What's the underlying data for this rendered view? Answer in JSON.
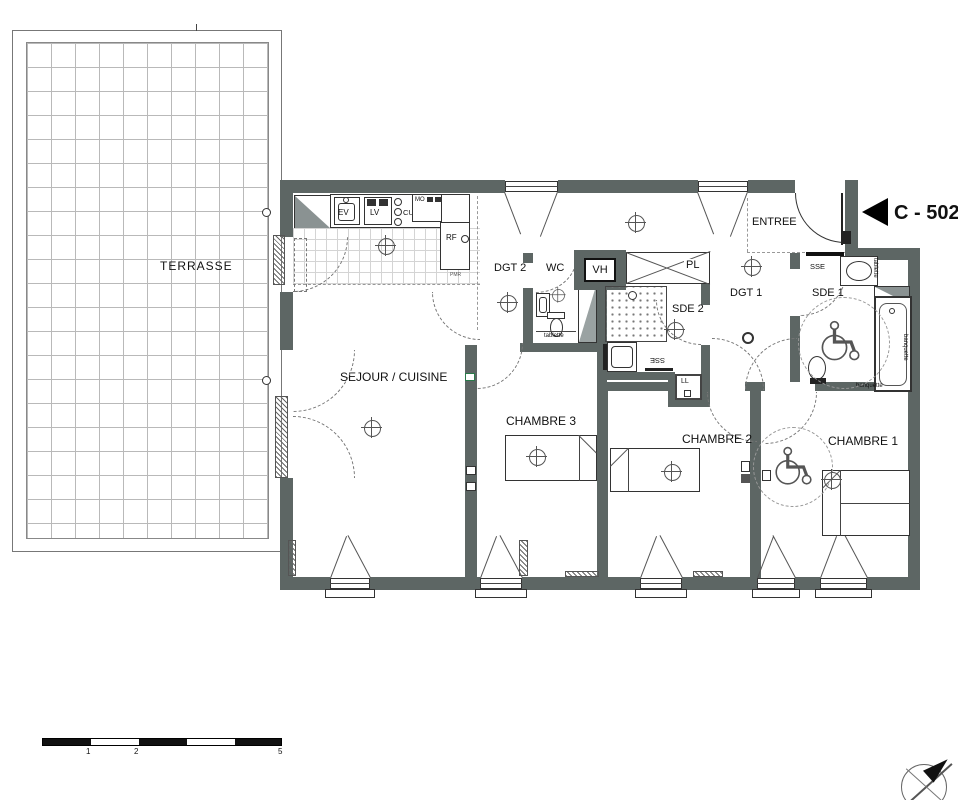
{
  "unit_label": "C - 502",
  "rooms": {
    "terrasse": "TERRASSE",
    "sejour": "SEJOUR / CUISINE",
    "dgt2": "DGT 2",
    "wc": "WC",
    "vh": "VH",
    "pl": "PL",
    "sde2": "SDE 2",
    "dgt1": "DGT 1",
    "entree": "ENTREE",
    "sde1": "SDE 1",
    "chambre3": "CHAMBRE 3",
    "chambre2": "CHAMBRE 2",
    "chambre1": "CHAMBRE 1"
  },
  "kitchen": {
    "ev": "EV",
    "lv": "LV",
    "cu": "CU",
    "mo": "MO",
    "rf": "RF",
    "pmr": "PMR"
  },
  "fixtures": {
    "ll": "LL",
    "sse": "SSE",
    "tablette": "tablette",
    "banquette": "banquette"
  },
  "scale_bar": {
    "tick1": "1",
    "tick2": "2",
    "tick5": "5"
  },
  "colors": {
    "wall": "#5d6664",
    "marker": "#000000"
  }
}
